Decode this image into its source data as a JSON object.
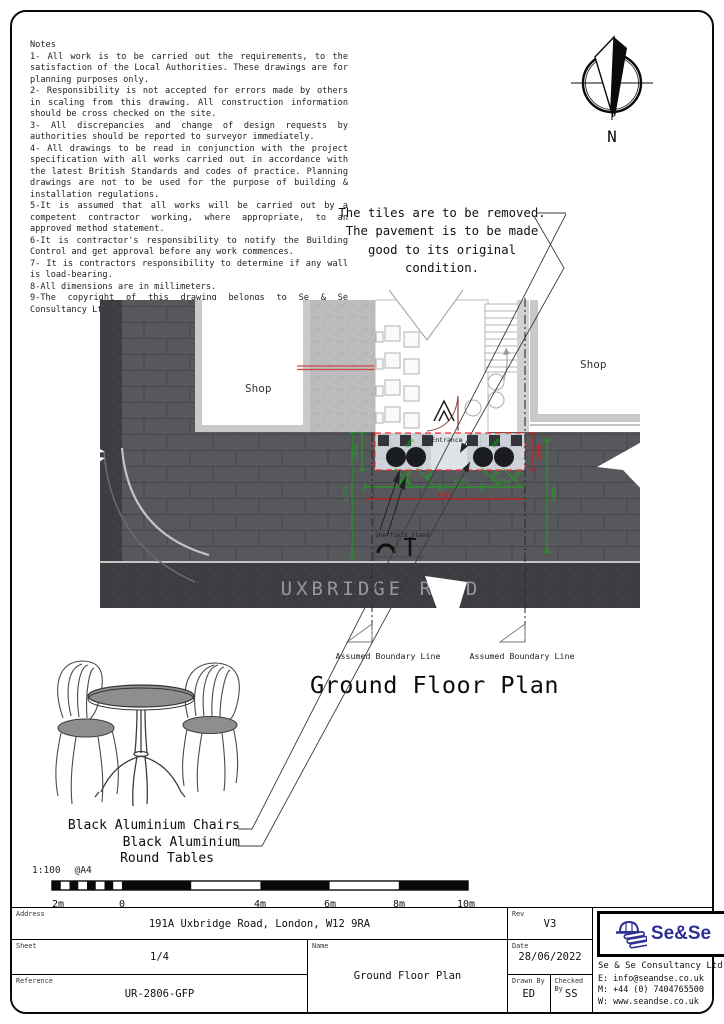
{
  "notes": {
    "title": "Notes",
    "lines": [
      "1- All work is to be carried out the requirements, to the satisfaction of the Local Authorities. These drawings are for planning purposes only.",
      "2- Responsibility is not accepted for errors made by others in scaling from this drawing. All construction information should be cross checked on the site.",
      "3- All discrepancies and change of design requests by authorities should be reported to surveyor immediately.",
      "4- All drawings to be read in conjunction with the project specification with all works carried out in accordance with the latest British Standards and codes of practice. Planning drawings are not to be used for the purpose of building & installation regulations.",
      "5-It is assumed that all works will be carried out by a competent contractor working, where appropriate, to an approved method statement.",
      "6-It is contractor's responsibility to notify the Building Control and get approval before any work commences.",
      "7- It is contractors responsibility to determine if any wall is load-bearing.",
      "8-All dimensions are in millimeters.",
      "9-The copyright of this drawing belongs to Se & Se Consultancy Ltd."
    ]
  },
  "north": {
    "label": "N"
  },
  "tiles_note": {
    "line1": "The tiles are to be removed.",
    "line2": "The pavement is to be made",
    "line3": "good to its original condition."
  },
  "plan": {
    "shop_left": "Shop",
    "shop_right": "Shop",
    "entrance": "Entrance",
    "road": "UXBRIDGE ROAD",
    "sheffield_stand": "Sheffield Stand",
    "boundary_left": "Assumed Boundary Line",
    "boundary_right": "Assumed Boundary Line",
    "dims": {
      "depth_left": "1000",
      "depth_right": "1000",
      "left_run": "1778",
      "right_run": "1800",
      "seg1": "1488",
      "seg2": "1052",
      "seg3": "1824",
      "total": "4387",
      "table_gap": "600"
    }
  },
  "drawing_title": "Ground Floor Plan",
  "furniture": {
    "label_line1": "Black Aluminium Chairs",
    "label_line2": "Black Aluminium",
    "label_line3": "Round Tables"
  },
  "scale": {
    "ratio": "1:100",
    "paper": "@A4",
    "ticks": [
      "2m",
      "0",
      "4m",
      "6m",
      "8m",
      "10m"
    ]
  },
  "title_block": {
    "address_label": "Address",
    "address": "191A Uxbridge Road, London, W12 9RA",
    "sheet_label": "Sheet",
    "sheet": "1/4",
    "reference_label": "Reference",
    "reference": "UR-2806-GFP",
    "name_label": "Name",
    "name": "Ground Floor Plan",
    "rev_label": "Rev",
    "rev": "V3",
    "date_label": "Date",
    "date": "28/06/2022",
    "drawn_label": "Drawn By",
    "drawn": "ED",
    "checked_label": "Checked By",
    "checked": "SS",
    "logo_text": "Se&Se",
    "company": "Se & Se Consultancy Ltd.",
    "email": "E: info@seandse.co.uk",
    "phone": "M: +44 (0) 7404765500",
    "website": "W: www.seandse.co.uk"
  },
  "colors": {
    "dim_green": "#12b012",
    "dim_red": "#e81010",
    "logo_navy": "#2e3192",
    "pavement": "#57585c",
    "road": "#3c3d41"
  }
}
